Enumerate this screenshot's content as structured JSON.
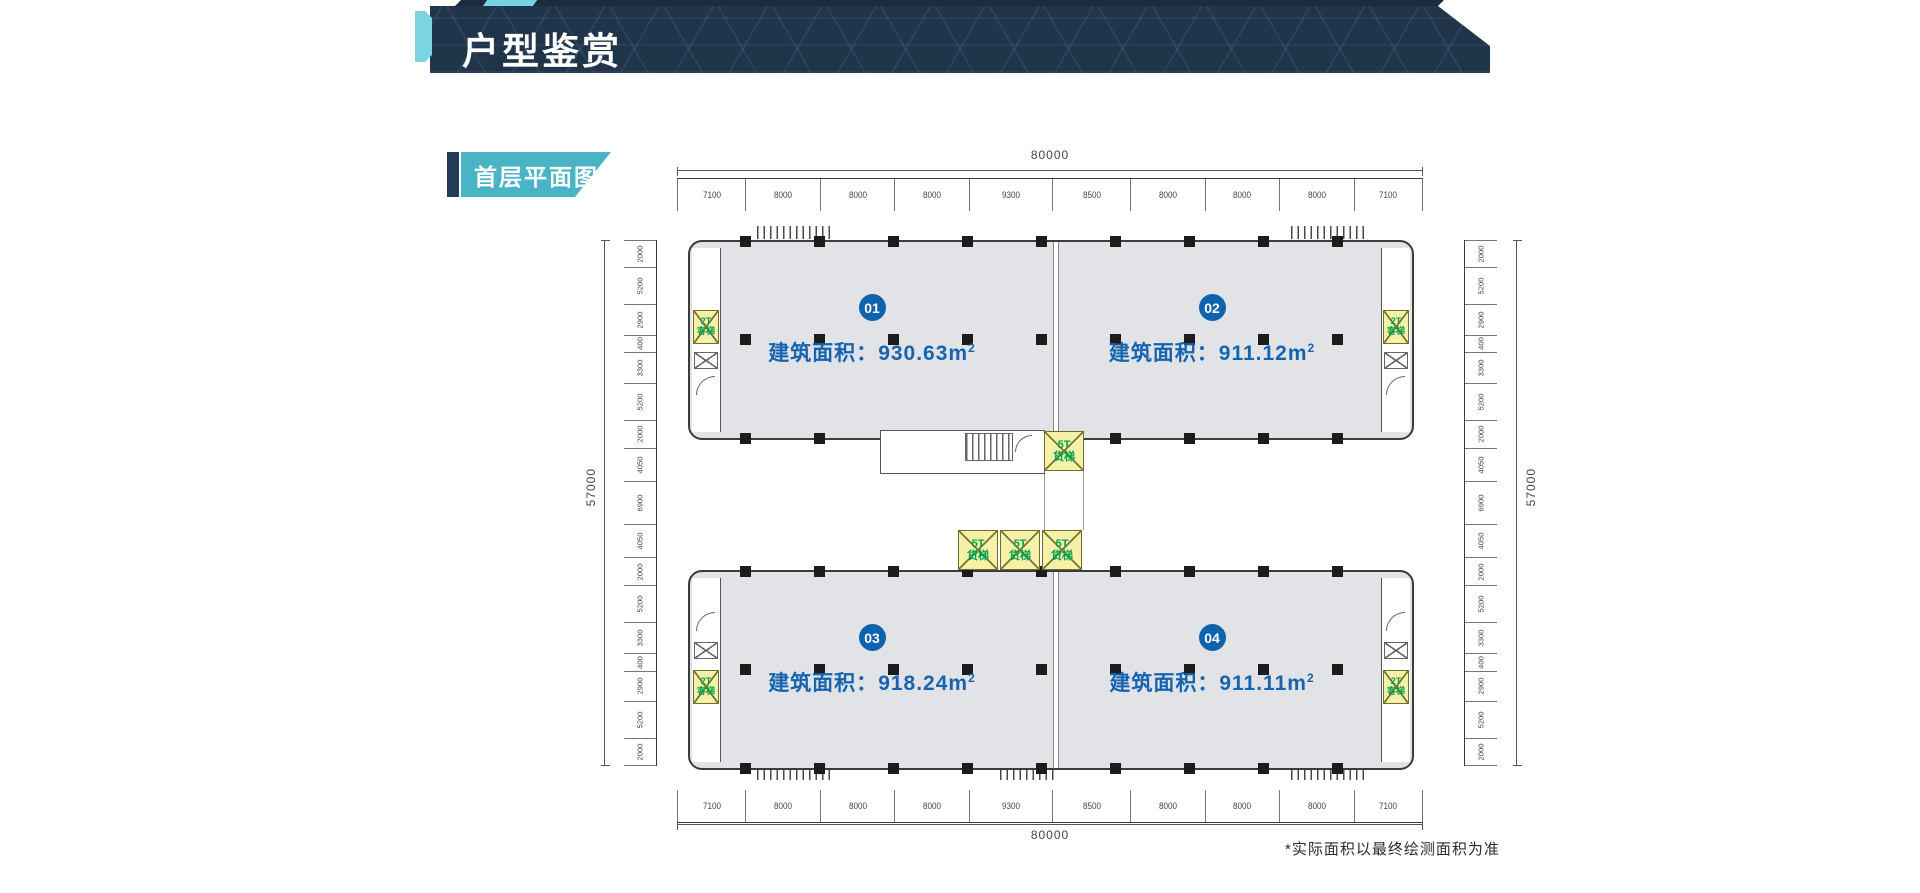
{
  "header": {
    "title": "户型鉴赏"
  },
  "section_label": {
    "text": "首层平面图"
  },
  "plan": {
    "units": [
      {
        "no": "01",
        "area_prefix": "建筑面积：",
        "area_value": "930.63",
        "area_m": "m",
        "area_sup": "2"
      },
      {
        "no": "02",
        "area_prefix": "建筑面积：",
        "area_value": "911.12",
        "area_m": "m",
        "area_sup": "2"
      },
      {
        "no": "03",
        "area_prefix": "建筑面积：",
        "area_value": "918.24",
        "area_m": "m",
        "area_sup": "2"
      },
      {
        "no": "04",
        "area_prefix": "建筑面积：",
        "area_value": "911.11",
        "area_m": "m",
        "area_sup": "2"
      }
    ],
    "elevators": {
      "passenger": {
        "line1": "2T",
        "line2": "客梯"
      },
      "freight": {
        "line1": "5T",
        "line2": "货梯"
      }
    },
    "dimensions": {
      "overall_width": "80000",
      "overall_height": "57000",
      "top_segments": [
        "7100",
        "8000",
        "8000",
        "8000",
        "9300",
        "8500",
        "8000",
        "8000",
        "8000",
        "7100"
      ],
      "bottom_segments": [
        "7100",
        "8000",
        "8000",
        "8000",
        "9300",
        "8500",
        "8000",
        "8000",
        "8000",
        "7100"
      ],
      "left_segments": [
        "2000",
        "5200",
        "2900",
        "400",
        "3300",
        "5200",
        "2000",
        "4050",
        "6900",
        "4050",
        "2000",
        "5200",
        "3300",
        "400",
        "2900",
        "5200",
        "2000"
      ],
      "right_segments": [
        "2000",
        "5200",
        "2900",
        "400",
        "3300",
        "5200",
        "2000",
        "4050",
        "6900",
        "4050",
        "2000",
        "5200",
        "3300",
        "400",
        "2900",
        "5200",
        "2000"
      ]
    }
  },
  "footnote": "*实际面积以最终绘测面积为准",
  "colors": {
    "banner_navy": "#20344a",
    "accent_cyan": "#79d2e2",
    "label_teal": "#49b4c5",
    "unit_blue": "#0f62ad",
    "floor_gray": "#e2e3e6",
    "elevator_yellow": "#f6f0a8",
    "elevator_green": "#00a14e"
  }
}
